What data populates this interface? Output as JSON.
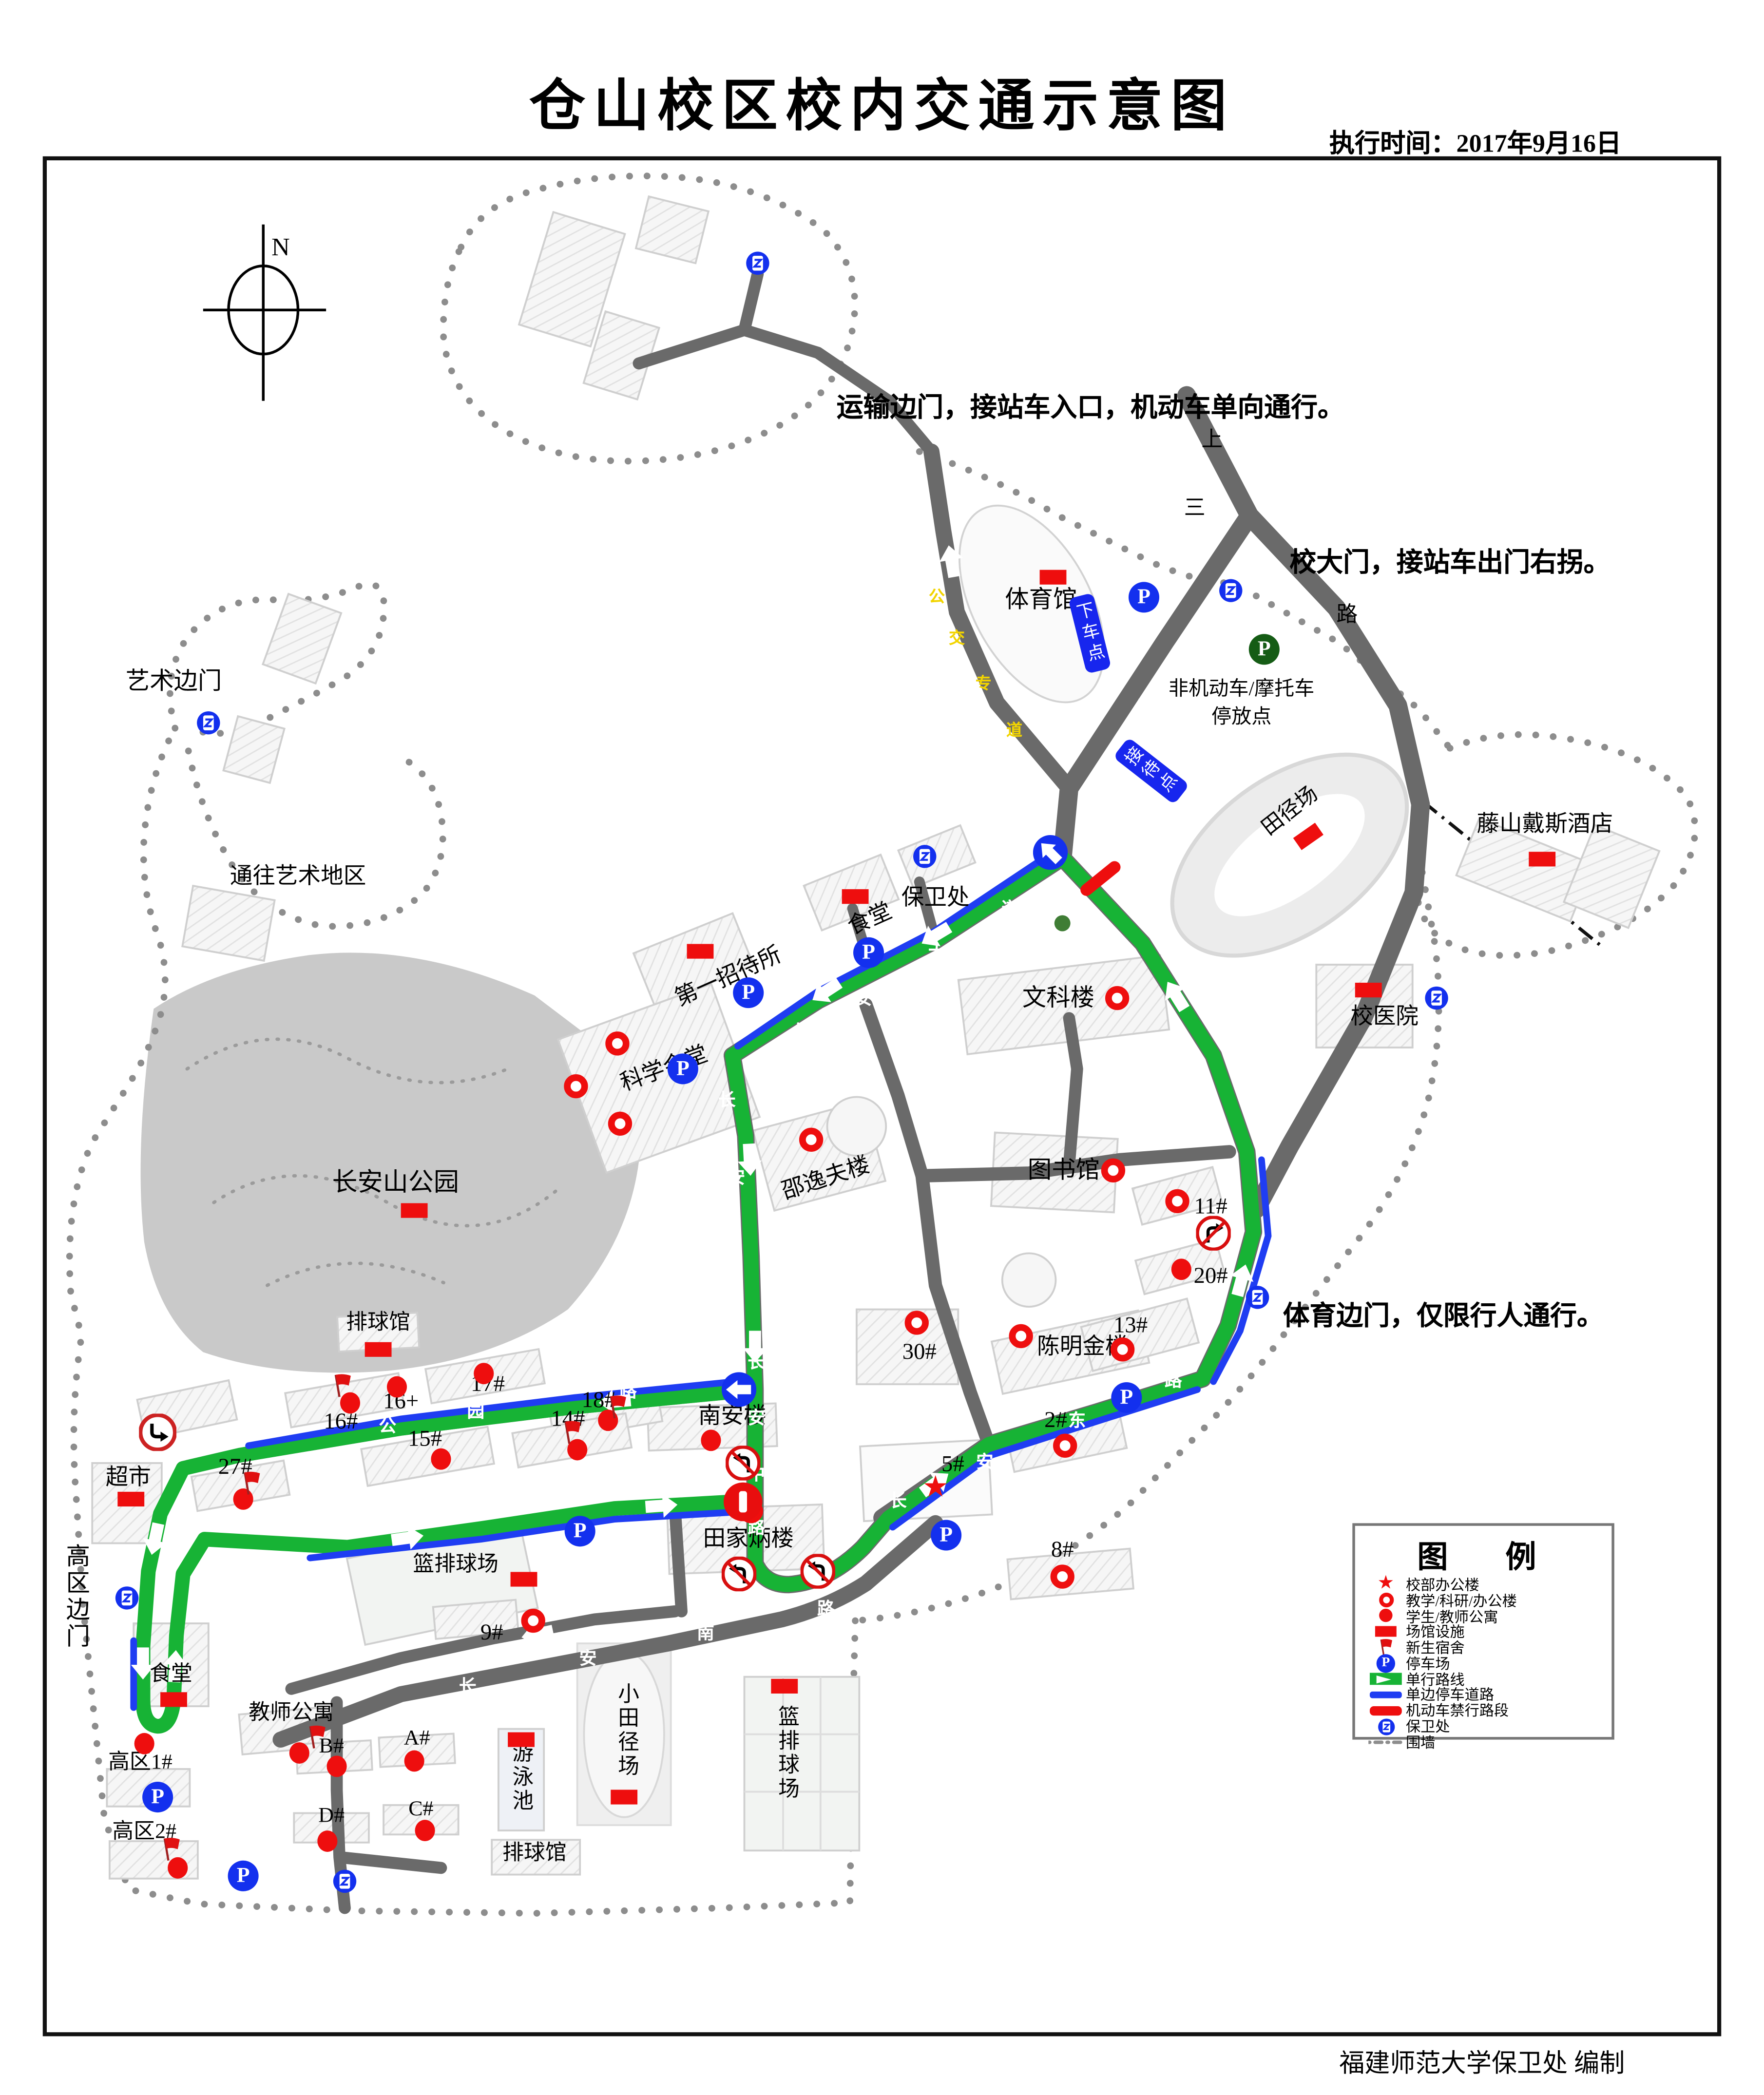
{
  "title": "仓山校区校内交通示意图",
  "meta": {
    "exec_time": "执行时间：2017年9月16日",
    "credit": "福建师范大学保卫处  编制",
    "north": "N"
  },
  "icons": {
    "parking": "P",
    "star": "★"
  },
  "annotations": {
    "transport_gate": "运输边门，接站车入口，机动车单向通行。",
    "main_gate": "校大门，接站车出门右拐。",
    "sports_gate": "体育边门，仅限行人通行。",
    "art_gate": "艺术边门",
    "to_art": "通往艺术地区",
    "highzone_gate": "高区边门",
    "nonmotor1": "非机动车/摩托车",
    "nonmotor2": "停放点"
  },
  "tags": {
    "dropoff": "下车点",
    "reception": "接待点"
  },
  "places": {
    "gym": "体育馆",
    "security_hq": "保卫处",
    "canteen1": "食堂",
    "guesthouse": "第一招待所",
    "wenke": "文科楼",
    "hospital": "校医院",
    "hotel": "藤山戴斯酒店",
    "track": "田径场",
    "science_hall": "科学会堂",
    "shaoyifu": "邵逸夫楼",
    "library": "图书馆",
    "park": "长安山公园",
    "volleyball1": "排球馆",
    "chenmingjin": "陈明金楼",
    "nanan": "南安楼",
    "supermarket": "超市",
    "tianjiabing": "田家炳楼",
    "small_track": "小田径场",
    "courts_v": "篮排球场",
    "courts_h": "篮排球场",
    "canteen2": "食堂",
    "teacher_apt": "教师公寓",
    "pool": "游泳池",
    "volleyball2": "排球馆"
  },
  "units": {
    "u30": "30#",
    "u13": "13#",
    "u11": "11#",
    "u20": "20#",
    "u2": "2#",
    "u5": "5#",
    "u8": "8#",
    "u18": "18#",
    "u17": "17#",
    "u16p": "16+",
    "u16": "16#",
    "u15": "15#",
    "u14": "14#",
    "u27": "27#",
    "u9": "9#",
    "gao1": "高区1#",
    "gao2": "高区2#",
    "uA": "A#",
    "uB": "B#",
    "uC": "C#",
    "uD": "D#"
  },
  "roads": {
    "dadao": [
      "长",
      "安",
      "大",
      "道"
    ],
    "zhong_up": [
      "长",
      "安"
    ],
    "zhong": [
      "长",
      "安",
      "中",
      "路"
    ],
    "dong": [
      "长",
      "安",
      "东",
      "路"
    ],
    "gongyuan": [
      "公",
      "园",
      "路"
    ],
    "qinghua": [
      "青",
      "华",
      "路"
    ],
    "nanlu": [
      "长",
      "安",
      "南",
      "路"
    ],
    "busway": [
      "公",
      "交",
      "专",
      "道"
    ],
    "outer": [
      "上",
      "三",
      "路"
    ]
  },
  "legend": {
    "title": "图　例",
    "items": [
      "校部办公楼",
      "教学/科研/办公楼",
      "学生/教师公寓",
      "场馆设施",
      "新生宿舍",
      "停车场",
      "单行路线",
      "单边停车道路",
      "机动车禁行路段",
      "保卫处",
      "围墙"
    ]
  },
  "colors": {
    "route_green": "#17b335",
    "parking_blue": "#1330ee",
    "road_gray": "#6a6a6a",
    "mark_red": "#ee0e0e",
    "side_blue": "#1f3df2"
  }
}
